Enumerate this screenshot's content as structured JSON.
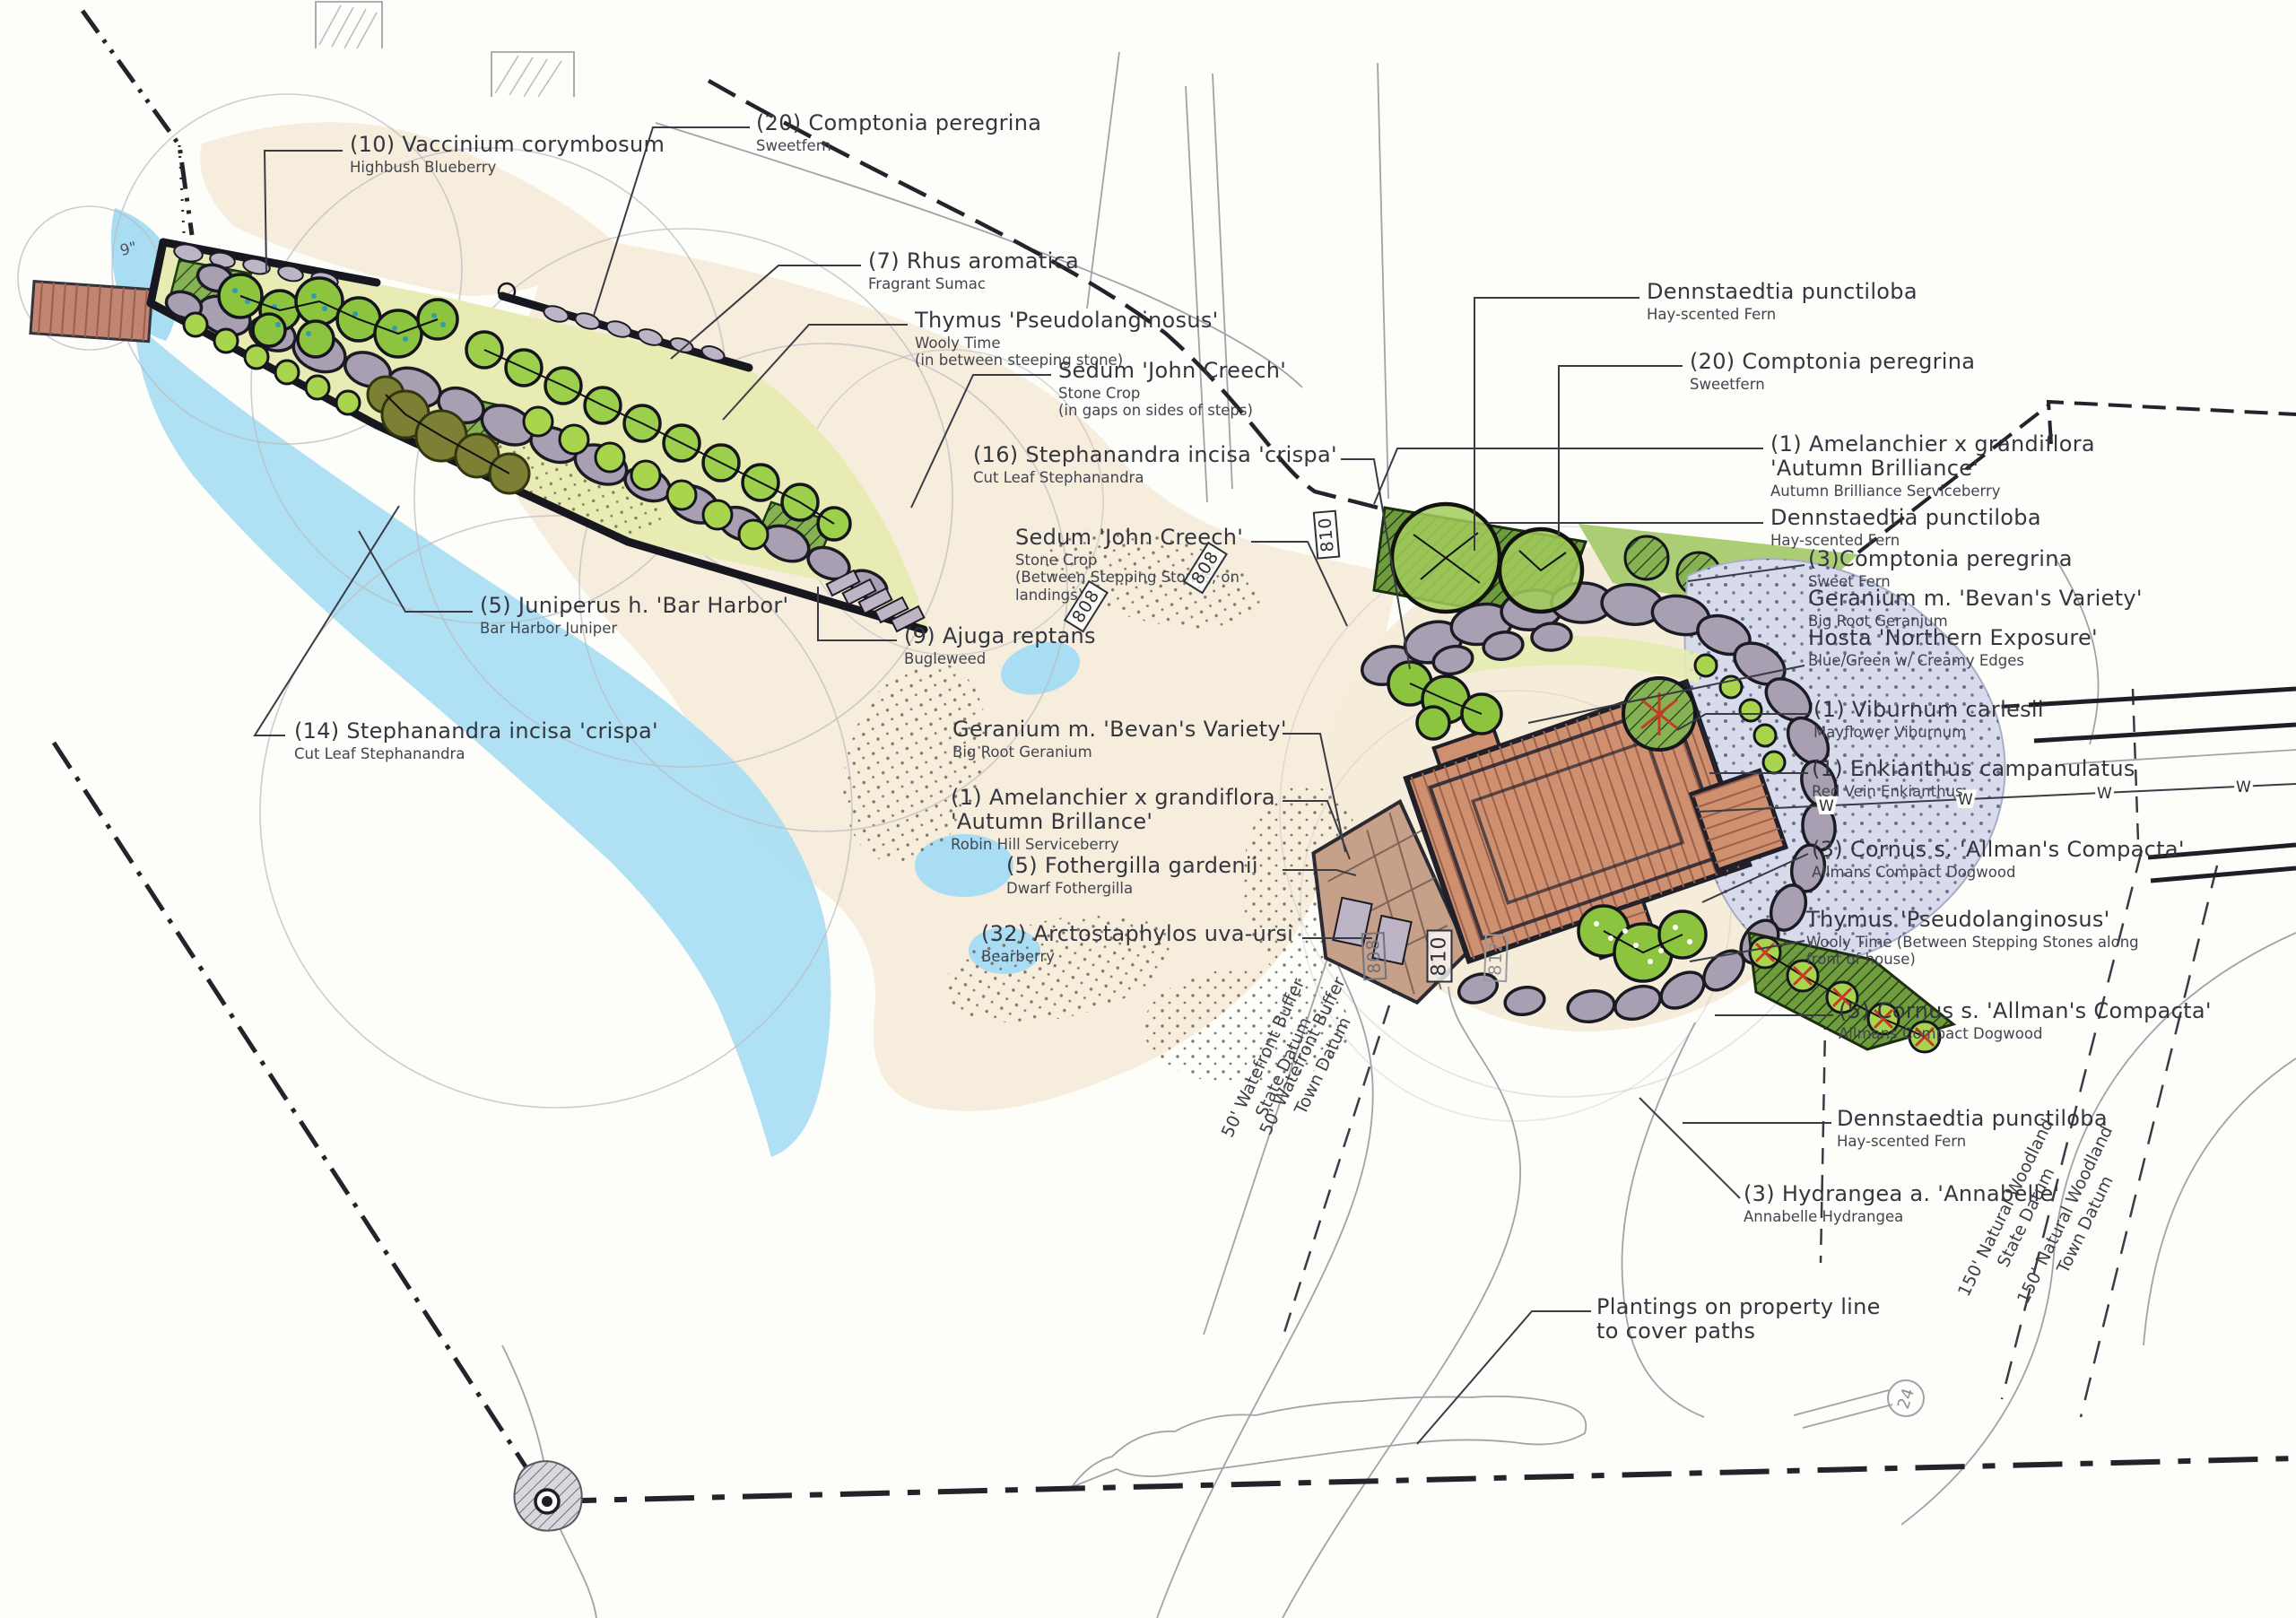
{
  "page": {
    "background": "#fdfdfa",
    "ink": "#2a2b33",
    "accent_red": "#c63a26",
    "water_color": "#a8ddf3",
    "sand_color": "#f6eddc",
    "stone_color": "#a89fb2",
    "roof_color": "#cf9070"
  },
  "plant_labels": [
    {
      "t1": "(10) Vaccinium corymbosum",
      "s1": "Highbush Blueberry"
    },
    {
      "t1": "(20) Comptonia peregrina",
      "s1": "Sweetfern"
    },
    {
      "t1": "(7) Rhus aromatica",
      "s1": "Fragrant Sumac"
    },
    {
      "t1": "Thymus 'Pseudolanginosus'",
      "s1": "Wooly Time",
      "s2": "(in between steeping stone)"
    },
    {
      "t1": "Sedum 'John Creech'",
      "s1": "Stone Crop",
      "s2": "(in gaps on sides of steps)"
    },
    {
      "t1": "(16) Stephanandra incisa 'crispa'",
      "s1": "Cut Leaf Stephanandra"
    },
    {
      "t1": "Sedum 'John Creech'",
      "s1": "Stone Crop",
      "s2": "(Between Stepping Stones, on",
      "s3": "landings)"
    },
    {
      "t1": "(9) Ajuga reptans",
      "s1": "Bugleweed"
    },
    {
      "t1": "(5) Juniperus h. 'Bar Harbor'",
      "s1": "Bar Harbor Juniper"
    },
    {
      "t1": "(14) Stephanandra incisa 'crispa'",
      "s1": "Cut Leaf Stephanandra"
    },
    {
      "t1": "Geranium m. 'Bevan's Variety'",
      "s1": "Big Root Geranium"
    },
    {
      "t1": "(1) Amelanchier x grandiflora",
      "t2": "'Autumn Brillance'",
      "s1": "Robin Hill Serviceberry"
    },
    {
      "t1": "(5) Fothergilla gardenii",
      "s1": "Dwarf Fothergilla"
    },
    {
      "t1": "(32) Arctostaphylos uva-ursi",
      "s1": "Bearberry"
    },
    {
      "t1": "Dennstaedtia punctiloba",
      "s1": "Hay-scented Fern"
    },
    {
      "t1": "(20) Comptonia peregrina",
      "s1": "Sweetfern"
    },
    {
      "t1": "(1) Amelanchier x grandiflora",
      "t2": "'Autumn Brilliance'",
      "s1": "Autumn Brilliance Serviceberry"
    },
    {
      "t1": "Dennstaedtia punctiloba",
      "s1": "Hay-scented Fern"
    },
    {
      "t1": "(3)Comptonia peregrina",
      "s1": "Sweet Fern"
    },
    {
      "t1": "Geranium m. 'Bevan's Variety'",
      "s1": "Big Root Geranium"
    },
    {
      "t1": "Hosta 'Northern Exposure'",
      "s1": "Blue/Green w/ Creamy Edges"
    },
    {
      "t1": "(1) Viburnum carlesii",
      "s1": "Mayflower Viburnum"
    },
    {
      "t1": "(1) Enkianthus campanulatus",
      "s1": "Red Vein Enkianthus"
    },
    {
      "t1": "(3) Cornus s. 'Allman's Compacta'",
      "s1": "Allmans Compact Dogwood"
    },
    {
      "t1": "Thymus 'Pseudolanginosus'",
      "s1": "Wooly Time (Between Stepping Stones along",
      "s2": "front of house)"
    },
    {
      "t1": "(5) Cornus s. 'Allman's Compacta'",
      "s1": "Allmans Compact Dogwood"
    },
    {
      "t1": "Dennstaedtia punctiloba",
      "s1": "Hay-scented Fern"
    },
    {
      "t1": "(3) Hydrangea a. 'Annabelle'",
      "s1": "Annabelle Hydrangea"
    },
    {
      "t1": "Plantings on property line",
      "t2": "to cover paths"
    }
  ],
  "datum_labels": [
    {
      "l1": "50' Watefront Buffer",
      "l2": "State Datum"
    },
    {
      "l1": "50' Watefront Buffer",
      "l2": "Town Datum"
    },
    {
      "l1": "150' Natural Woodland",
      "l2": "State Datum"
    },
    {
      "l1": "150' Natural Woodland",
      "l2": "Town Datum"
    }
  ],
  "contour_tags": [
    {
      "v": "810"
    },
    {
      "v": "810"
    },
    {
      "v": "812"
    },
    {
      "v": "808"
    },
    {
      "v": "808"
    },
    {
      "v": "808"
    }
  ],
  "annotations": {
    "dock_note": "9\"",
    "tree_tag": "24",
    "water_symbol": "W"
  }
}
